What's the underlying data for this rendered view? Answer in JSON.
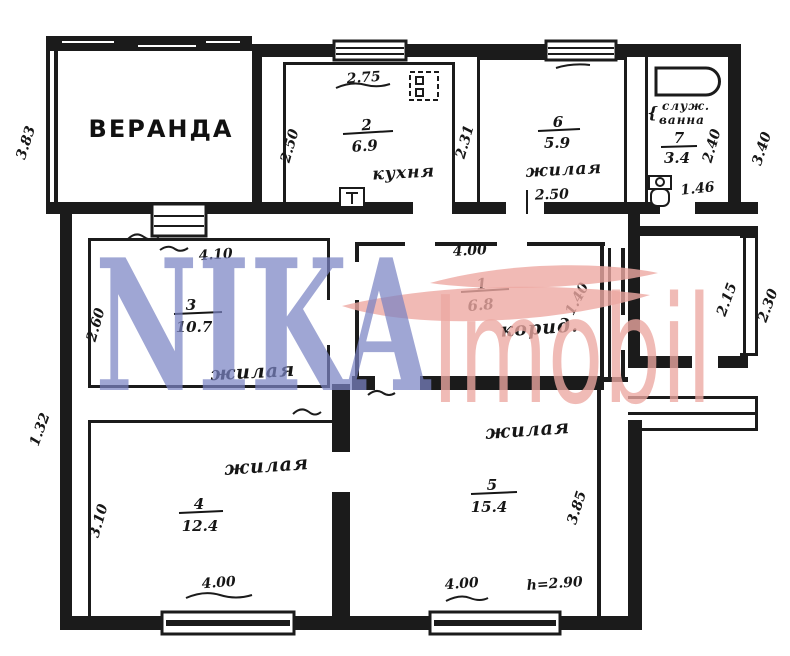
{
  "veranda": {
    "label": "ВЕРАНДА"
  },
  "rooms": {
    "corridor": {
      "number": "1",
      "area": "6.8",
      "name": "корид."
    },
    "kitchen": {
      "number": "2",
      "area": "6.9",
      "name": "кухня"
    },
    "living3": {
      "number": "3",
      "area": "10.7",
      "name": "жилая"
    },
    "living4": {
      "number": "4",
      "area": "12.4",
      "name": "жилая"
    },
    "living5": {
      "number": "5",
      "area": "15.4",
      "name": "жилая"
    },
    "living6": {
      "number": "6",
      "area": "5.9",
      "name": "жилая"
    },
    "bath": {
      "number": "7",
      "area": "3.4",
      "name_line1": "служ.",
      "name_line2": "ванна",
      "brace": "{"
    }
  },
  "dimensions": {
    "veranda_left": "3.83",
    "kitchen_top": "2.75",
    "kitchen_left": "2.50",
    "room6_left": "2.31",
    "room6_bottom": "2.50",
    "bath_right": "2.40",
    "bath_bottom": "1.46",
    "outer_right_top": "3.40",
    "room3_top": "4.10",
    "room3_left": "2.60",
    "corridor_top": "4.00",
    "corridor_right": "1.40",
    "porch_inner": "2.15",
    "porch_outer": "2.30",
    "outer_left_bottom": "1.32",
    "room4_left": "3.10",
    "room4_bottom": "4.00",
    "room5_bottom": "4.00",
    "room5_right": "3.85",
    "ceiling_height": "h=2.90"
  },
  "watermark": {
    "primary": "NIKA",
    "secondary": "Imobil",
    "primary_color": "#7b84c4",
    "secondary_color": "#eda9a2"
  },
  "ink_color": "#1b1b1b"
}
